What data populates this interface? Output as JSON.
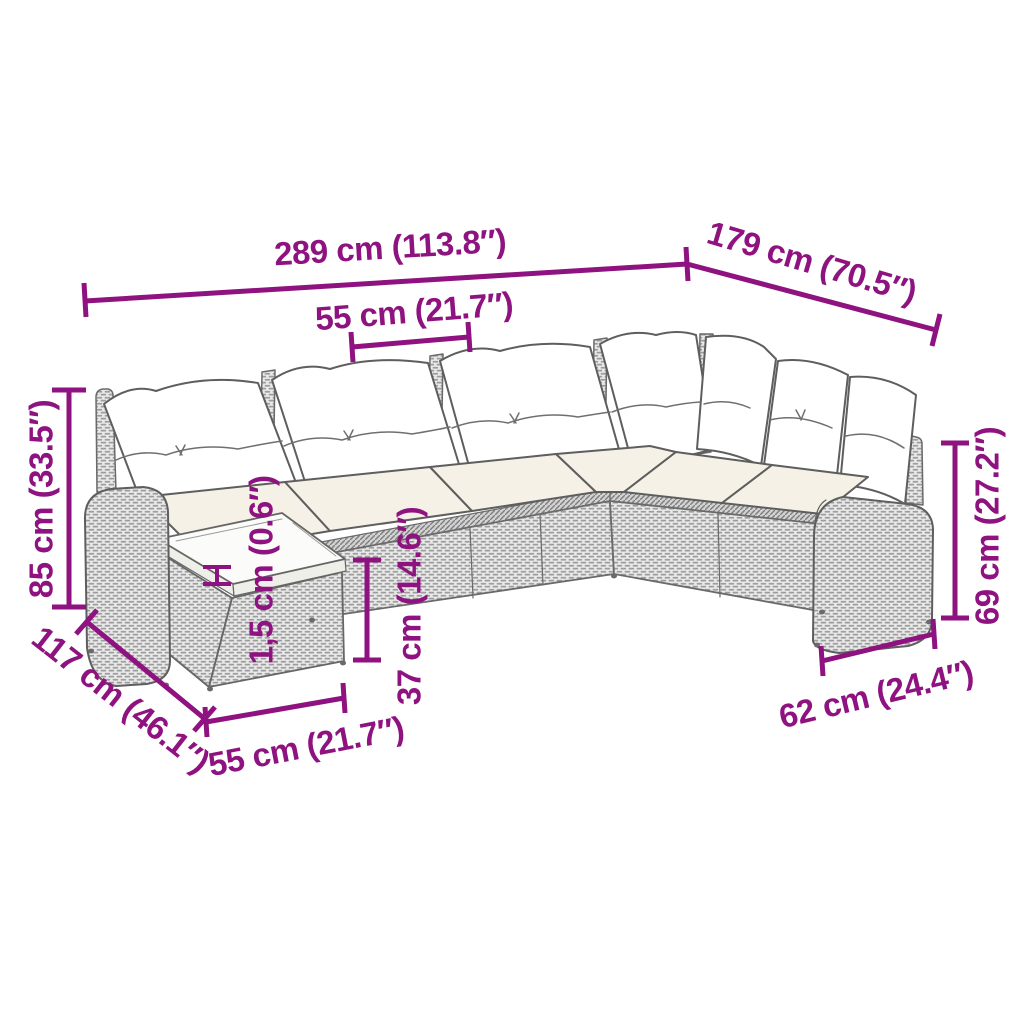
{
  "diagram": {
    "kind": "furniture dimension drawing",
    "subject": "poly rattan corner sofa set with cushions and glass-top side table",
    "background_color": "#FFFFFF",
    "accent_color": "#8E127F",
    "outline_color": "#5E5E5E"
  },
  "dimensions": {
    "overall_width": "289 cm (113.8″)",
    "right_section_depth": "179 cm (70.5″)",
    "seat_width": "55 cm (21.7″)",
    "overall_height": "85 cm (33.5″)",
    "left_section_depth": "117 cm (46.1″)",
    "table_width": "55 cm (21.7″)",
    "tabletop_thickness": "1,5 cm (0.6″)",
    "table_height": "37 cm (14.6″)",
    "armrest_height": "69 cm (27.2″)",
    "armrest_section_depth": "62 cm (24.4″)"
  }
}
